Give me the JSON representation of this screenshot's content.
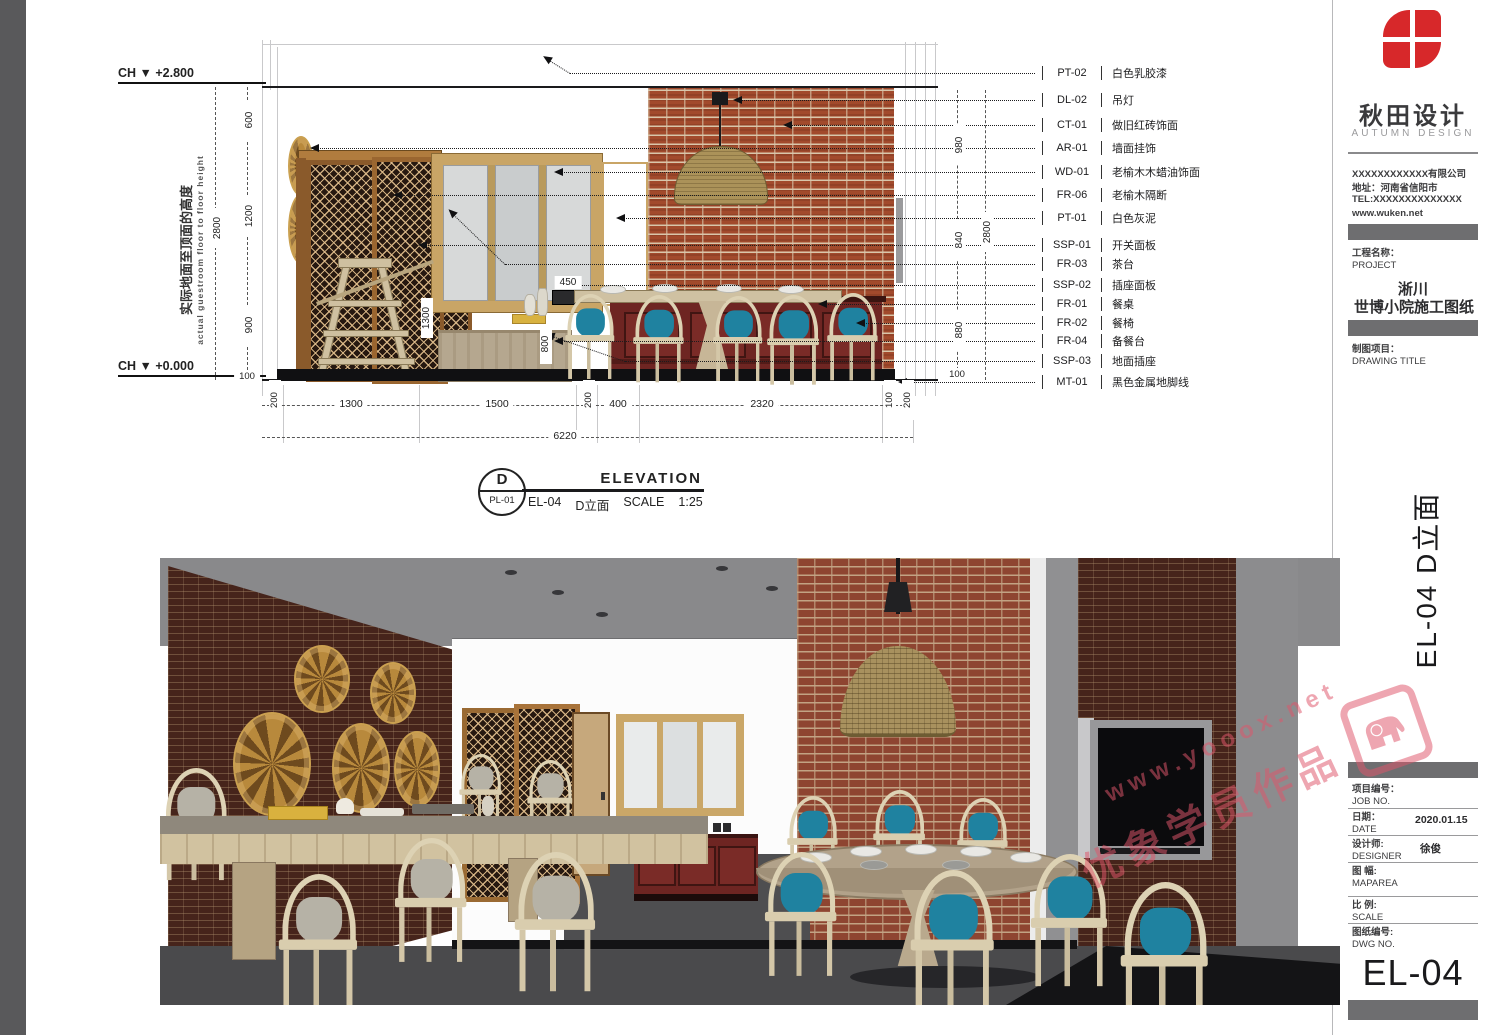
{
  "logo": {
    "cn": "秋田设计",
    "en": "AUTUMN DESIGN"
  },
  "company": {
    "name": "XXXXXXXXXXXX有限公司",
    "address": "地址：河南省信阳市",
    "tel": "TEL:XXXXXXXXXXXXXX",
    "web": "www.wuken.net"
  },
  "title_block": {
    "project_label_cn": "工程名称：",
    "project_label_en": "PROJECT",
    "project_line1": "淅川",
    "project_line2": "世博小院施工图纸",
    "drawing_label_cn": "制图项目：",
    "drawing_label_en": "DRAWING TITLE",
    "side_title": "EL-04  D立面",
    "fields": [
      {
        "cn": "项目编号：",
        "en": "JOB NO.",
        "value": ""
      },
      {
        "cn": "日期：",
        "en": "DATE",
        "value": "2020.01.15"
      },
      {
        "cn": "设计师:",
        "en": "DESIGNER",
        "value": "徐俊"
      },
      {
        "cn": "图 幅:",
        "en": "MAPAREA",
        "value": ""
      },
      {
        "cn": "比 例:",
        "en": "SCALE",
        "value": ""
      },
      {
        "cn": "图纸编号:",
        "en": "DWG NO.",
        "value": ""
      }
    ],
    "dwg_no": "EL-04"
  },
  "elevation": {
    "level_top": "CH ▼ +2.800",
    "level_bottom": "CH ▼ +0.000",
    "height_note_cn": "实际地面至顶面的高度",
    "height_note_en": "actual guestroom floor to floor height",
    "dims_left": [
      "600",
      "1200",
      "900",
      "100"
    ],
    "dims_left_total": "2800",
    "dims_right": [
      "980",
      "840",
      "880",
      "100"
    ],
    "dims_right_total": "2800",
    "dims_bottom": [
      "200",
      "1300",
      "1500",
      "200",
      "400",
      "2320",
      "100",
      "200"
    ],
    "dims_bottom_total": "6220",
    "dims_inner": {
      "tea_table_h": "1300",
      "cabinet_h": "800",
      "switch_offset": "450"
    },
    "callouts": [
      {
        "code": "PT-02",
        "label": "白色乳胶漆"
      },
      {
        "code": "DL-02",
        "label": "吊灯"
      },
      {
        "code": "CT-01",
        "label": "做旧红砖饰面"
      },
      {
        "code": "AR-01",
        "label": "墙面挂饰"
      },
      {
        "code": "WD-01",
        "label": "老榆木木蜡油饰面"
      },
      {
        "code": "FR-06",
        "label": "老榆木隔断"
      },
      {
        "code": "PT-01",
        "label": "白色灰泥"
      },
      {
        "code": "SSP-01",
        "label": "开关面板"
      },
      {
        "code": "FR-03",
        "label": "茶台"
      },
      {
        "code": "SSP-02",
        "label": "插座面板"
      },
      {
        "code": "FR-01",
        "label": "餐桌"
      },
      {
        "code": "FR-02",
        "label": "餐椅"
      },
      {
        "code": "FR-04",
        "label": "备餐台"
      },
      {
        "code": "SSP-03",
        "label": "地面插座"
      },
      {
        "code": "MT-01",
        "label": "黑色金属地脚线"
      }
    ],
    "view_title": {
      "bubble_top": "D",
      "bubble_bottom": "PL-01",
      "heading": "ELEVATION",
      "code": "EL-04",
      "name": "D立面",
      "scale_label": "SCALE",
      "scale_value": "1:25"
    }
  },
  "watermark": {
    "url": "www.yooox.net",
    "caption": "优象学员作品"
  },
  "colors": {
    "brand_red": "#d7282a",
    "watermark_pink": "#e0566b",
    "cushion_teal": "#1f82a0",
    "brick_red": "#a24a2c"
  }
}
